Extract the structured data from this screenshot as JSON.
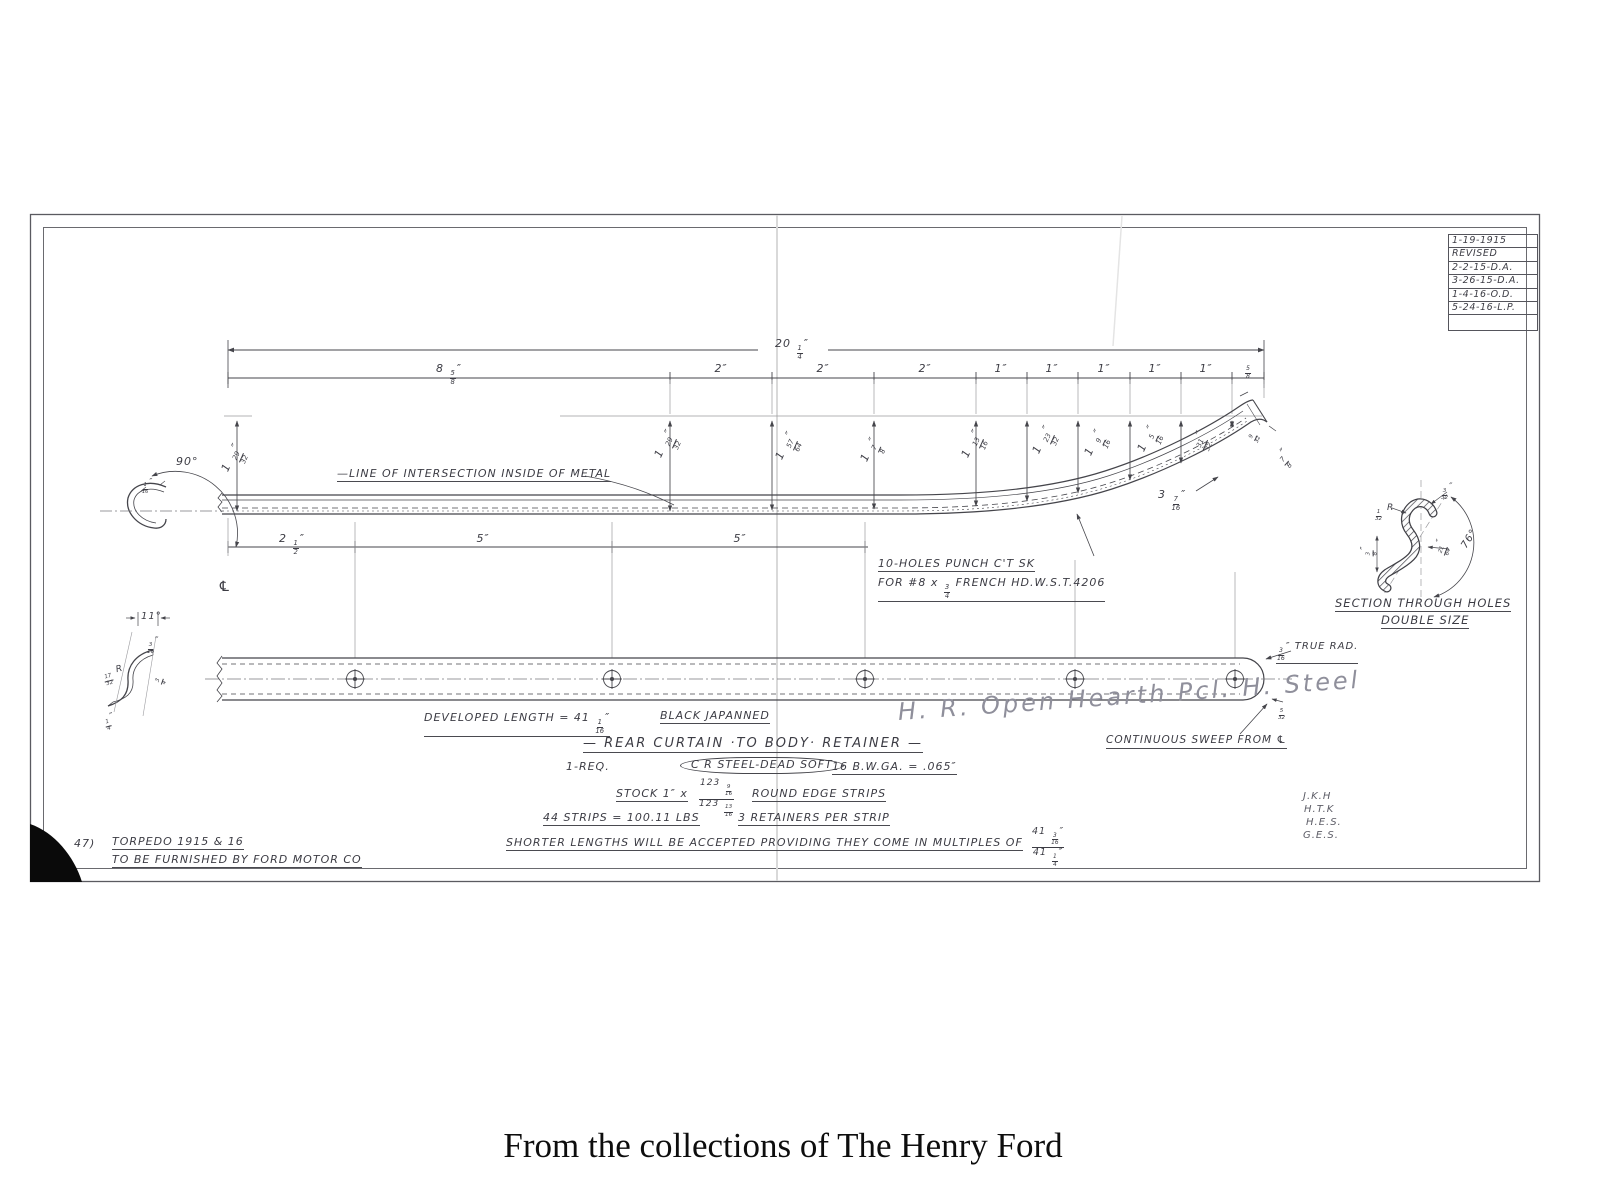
{
  "page": {
    "caption": "From the collections of The Henry Ford"
  },
  "colors": {
    "ink": "#45454b",
    "pencil": "#8f8f9b",
    "paper": "#ffffff"
  },
  "revision": {
    "rows": [
      "1-19-1915",
      "REVISED",
      "2-2-15-D.A.",
      "3-26-15-D.A.",
      "1-4-16-O.D.",
      "5-24-16-L.P."
    ]
  },
  "labels": [
    {
      "name": "dim-overall-length",
      "t": "20 1/4″",
      "x": 792,
      "y": 338,
      "c": 1
    },
    {
      "name": "dim-seg-1",
      "t": "8 5/8″",
      "x": 449,
      "y": 363,
      "c": 1
    },
    {
      "name": "dim-seg-2",
      "t": "2″",
      "x": 721,
      "y": 363,
      "c": 1
    },
    {
      "name": "dim-seg-3",
      "t": "2″",
      "x": 823,
      "y": 363,
      "c": 1
    },
    {
      "name": "dim-seg-4",
      "t": "2″",
      "x": 925,
      "y": 363,
      "c": 1
    },
    {
      "name": "dim-seg-5",
      "t": "1″",
      "x": 1001,
      "y": 363,
      "c": 1
    },
    {
      "name": "dim-seg-6",
      "t": "1″",
      "x": 1052,
      "y": 363,
      "c": 1
    },
    {
      "name": "dim-seg-7",
      "t": "1″",
      "x": 1104,
      "y": 363,
      "c": 1
    },
    {
      "name": "dim-seg-8",
      "t": "1″",
      "x": 1155,
      "y": 363,
      "c": 1
    },
    {
      "name": "dim-seg-9",
      "t": "1″",
      "x": 1206,
      "y": 363,
      "c": 1
    },
    {
      "name": "dim-seg-10",
      "t": "5/8",
      "x": 1248,
      "y": 359,
      "c": 1,
      "fs": 10
    },
    {
      "name": "dim-height-1",
      "t": "1 29/32″",
      "x": 230,
      "y": 462,
      "rot": -66
    },
    {
      "name": "dim-height-2",
      "t": "1 29/32″",
      "x": 663,
      "y": 448,
      "rot": -66
    },
    {
      "name": "dim-height-3",
      "t": "1 57/64″",
      "x": 784,
      "y": 450,
      "rot": -66
    },
    {
      "name": "dim-height-4",
      "t": "1 7/8″",
      "x": 869,
      "y": 452,
      "rot": -66
    },
    {
      "name": "dim-height-5",
      "t": "1 13/16″",
      "x": 970,
      "y": 448,
      "rot": -66
    },
    {
      "name": "dim-height-6",
      "t": "1 23/32″",
      "x": 1041,
      "y": 444,
      "rot": -66
    },
    {
      "name": "dim-height-7",
      "t": "1 9/16″",
      "x": 1093,
      "y": 446,
      "rot": -66
    },
    {
      "name": "dim-height-8",
      "t": "1 5/16″",
      "x": 1146,
      "y": 442,
      "rot": -66
    },
    {
      "name": "dim-height-9",
      "t": "31/32″",
      "x": 1199,
      "y": 438,
      "rot": -66
    },
    {
      "name": "dim-height-10",
      "t": "9/32",
      "x": 1251,
      "y": 432,
      "rot": -66,
      "fs": 9
    },
    {
      "name": "dim-tip-width",
      "t": "7/8″",
      "x": 1281,
      "y": 452,
      "rot": -48
    },
    {
      "name": "dim-curve-offset",
      "t": "3 7/16″",
      "x": 1158,
      "y": 489
    },
    {
      "name": "angle-90",
      "t": "90°",
      "x": 176,
      "y": 456
    },
    {
      "name": "dim-hook-thickness",
      "t": "1/16″",
      "x": 141,
      "y": 478,
      "fs": 8
    },
    {
      "name": "centerline-symbol",
      "t": "℄",
      "x": 218,
      "y": 580,
      "fs": 14
    },
    {
      "name": "note-line-of-intersection",
      "t": "—LINE OF INTERSECTION INSIDE OF METAL",
      "x": 337,
      "y": 468,
      "cls": "u"
    },
    {
      "name": "note-holes-1",
      "t": "10-HOLES PUNCH C'T SK",
      "x": 878,
      "y": 558,
      "cls": "u"
    },
    {
      "name": "note-holes-2",
      "t": "FOR #8 x 3/4 FRENCH HD.W.S.T.4206",
      "x": 878,
      "y": 577,
      "cls": "u"
    },
    {
      "name": "dim-hole-spacing-1",
      "t": "2 1/2″",
      "x": 292,
      "y": 533,
      "c": 1
    },
    {
      "name": "dim-hole-spacing-2",
      "t": "5″",
      "x": 483,
      "y": 533,
      "c": 1
    },
    {
      "name": "dim-hole-spacing-3",
      "t": "5″",
      "x": 740,
      "y": 533,
      "c": 1
    },
    {
      "name": "angle-11",
      "t": "11°",
      "x": 141,
      "y": 611,
      "fs": 10
    },
    {
      "name": "dim-left-section-1",
      "t": "3/16″",
      "x": 146,
      "y": 637,
      "fs": 9
    },
    {
      "name": "dim-left-section-radius",
      "t": "17/32 R",
      "x": 103,
      "y": 670,
      "fs": 9,
      "rot": -15
    },
    {
      "name": "dim-left-section-2",
      "t": "3/4",
      "x": 158,
      "y": 675,
      "fs": 9,
      "rot": -70
    },
    {
      "name": "dim-left-section-3",
      "t": "1/4″",
      "x": 104,
      "y": 715,
      "fs": 9,
      "rot": -15
    },
    {
      "name": "note-true-radius",
      "t": "3/16″ TRUE RAD.",
      "x": 1276,
      "y": 641,
      "fs": 10,
      "cls": "u"
    },
    {
      "name": "dim-end-1",
      "t": "5/32",
      "x": 1277,
      "y": 703,
      "fs": 9
    },
    {
      "name": "dim-section-1",
      "t": "3/32″",
      "x": 1440,
      "y": 483,
      "fs": 9
    },
    {
      "name": "dim-section-radius",
      "t": "1/32 R",
      "x": 1374,
      "y": 504,
      "fs": 9
    },
    {
      "name": "dim-section-2",
      "t": "3/8″",
      "x": 1370,
      "y": 548,
      "fs": 9,
      "rot": -90
    },
    {
      "name": "dim-section-3",
      "t": "21/64″",
      "x": 1441,
      "y": 546,
      "fs": 9,
      "rot": -70
    },
    {
      "name": "angle-76",
      "t": "76°",
      "x": 1464,
      "y": 542,
      "fs": 10,
      "rot": -58
    },
    {
      "name": "section-title",
      "t": "SECTION THROUGH HOLES",
      "x": 1335,
      "y": 597,
      "cls": "u",
      "fs": 11.5
    },
    {
      "name": "section-subtitle",
      "t": "DOUBLE SIZE",
      "x": 1381,
      "y": 614,
      "cls": "u",
      "fs": 11.5
    },
    {
      "name": "note-developed-length",
      "t": "DEVELOPED LENGTH = 41 1/16″",
      "x": 424,
      "y": 712,
      "cls": "u"
    },
    {
      "name": "note-finish",
      "t": "BLACK JAPANNED",
      "x": 660,
      "y": 710,
      "cls": "u"
    },
    {
      "name": "part-title",
      "t": "— REAR CURTAIN ·TO BODY· RETAINER —",
      "x": 583,
      "y": 737,
      "cls": "u title-big",
      "fs": 13
    },
    {
      "name": "note-quantity",
      "t": "1-REQ.",
      "x": 566,
      "y": 761
    },
    {
      "name": "note-material",
      "t": "C R STEEL-DEAD SOFT",
      "x": 680,
      "y": 757,
      "cls": "oval"
    },
    {
      "name": "note-gauge",
      "t": "16 B.W.GA. = .065″",
      "x": 832,
      "y": 761,
      "cls": "u"
    },
    {
      "name": "note-stock-pre",
      "t": "STOCK 1″ x",
      "x": 616,
      "y": 788,
      "cls": "u"
    },
    {
      "name": "note-stock-sizes",
      "t": "123 9/16|123 13/16",
      "x": 699,
      "y": 779,
      "cls": "stack",
      "fs": 9
    },
    {
      "name": "note-stock-post",
      "t": "ROUND EDGE STRIPS",
      "x": 752,
      "y": 788,
      "cls": "u"
    },
    {
      "name": "note-strip-weight",
      "t": "44 STRIPS = 100.11 LBS",
      "x": 543,
      "y": 812,
      "cls": "u"
    },
    {
      "name": "note-retainers",
      "t": "3 RETAINERS PER STRIP",
      "x": 738,
      "y": 812,
      "cls": "u"
    },
    {
      "name": "note-shorter-lengths",
      "t": "SHORTER LENGTHS WILL BE ACCEPTED PROVIDING THEY COME IN MULTIPLES OF",
      "x": 506,
      "y": 837,
      "cls": "u"
    },
    {
      "name": "note-multiples",
      "t": "41 3/16″|41 1/4″",
      "x": 1032,
      "y": 827,
      "cls": "stack",
      "fs": 9.5
    },
    {
      "name": "note-continuous-sweep",
      "t": "CONTINUOUS SWEEP FROM ℄",
      "x": 1106,
      "y": 735,
      "cls": "u",
      "fs": 10.5
    },
    {
      "name": "handwritten-steel-note",
      "t": "H. R. Open Hearth Pcl. H. Steel",
      "x": 898,
      "y": 698,
      "cls": "pencil",
      "rot": -4
    },
    {
      "name": "part-number",
      "t": "47)",
      "x": 74,
      "y": 838
    },
    {
      "name": "note-torpedo",
      "t": "TORPEDO 1915 & 16",
      "x": 112,
      "y": 836,
      "cls": "u"
    },
    {
      "name": "note-furnished",
      "t": "TO BE FURNISHED BY FORD MOTOR CO",
      "x": 112,
      "y": 854,
      "cls": "u"
    },
    {
      "name": "initials-1",
      "t": "J.K.H",
      "x": 1303,
      "y": 791,
      "cls": "pencil2",
      "fs": 10
    },
    {
      "name": "initials-2",
      "t": "H.T.K",
      "x": 1304,
      "y": 804,
      "cls": "pencil2",
      "fs": 10
    },
    {
      "name": "initials-3",
      "t": "H.E.S.",
      "x": 1306,
      "y": 817,
      "cls": "pencil2",
      "fs": 10
    },
    {
      "name": "initials-4",
      "t": "G.E.S.",
      "x": 1303,
      "y": 830,
      "cls": "pencil2",
      "fs": 10
    }
  ]
}
